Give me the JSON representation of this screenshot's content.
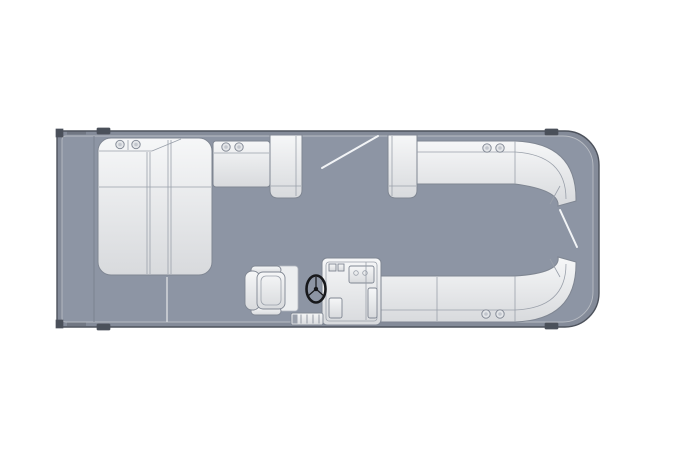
{
  "diagram": {
    "type": "pontoon-boat-floorplan-top-view",
    "components": [
      "hull",
      "deck",
      "stern-lounge-chaise",
      "aft-bench",
      "walkthrough-seat-left",
      "walkthrough-seat-right",
      "bow-top-bench",
      "bow-bottom-bench",
      "helm-console",
      "steering-wheel",
      "captains-chair",
      "boarding-ladder",
      "gate-swing-top",
      "gate-swing-bow",
      "cup-holders",
      "cleats"
    ],
    "counts": {
      "cup_holders": 8,
      "cleats": 4,
      "corner_blocks": 2
    }
  },
  "colors": {
    "background": "#ffffff",
    "hull": "#848b99",
    "hull_edge": "#4d525c",
    "deck": "#8d95a4",
    "deck_edge": "#b8bcc3",
    "cushion_light": "#f6f7f8",
    "cushion_dark": "#d8dadd",
    "cushion_stroke": "#7f8692",
    "seam": "#9aa0aa",
    "gate_line": "#f2f4f6",
    "wheel": "#17181b",
    "cleat": "#4a505a",
    "deck_seam_light": "#d8dbdf",
    "deck_seam_dark": "#7b8291"
  }
}
